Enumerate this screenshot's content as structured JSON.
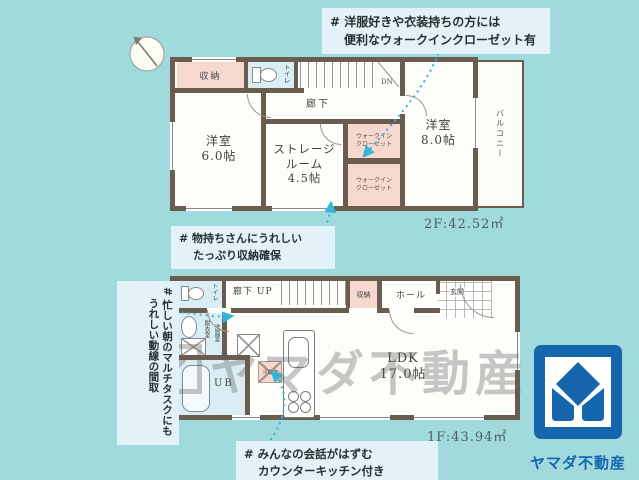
{
  "notes": {
    "wic": [
      "# 洋服好きや衣装持ちの方には",
      "便利なウォークインクローゼット有"
    ],
    "storage": [
      "# 物持ちさんにうれしい",
      "たっぷり収納確保"
    ],
    "morning": [
      "# 忙しい朝のマルチタスクにも",
      "うれしい動線の間取"
    ],
    "kitchen": [
      "# みんなの会話がはずむ",
      "カウンターキッチン付き"
    ]
  },
  "floor2": {
    "area": "2F:42.52㎡",
    "closet": "収納",
    "toilet": "トイレ",
    "hallway": "廊下",
    "stairs_dn": "DN",
    "bedroom6": "洋室",
    "bedroom6_size": "6.0帖",
    "storage_room_1": "ストレージ",
    "storage_room_2": "ルーム",
    "storage_room_size": "4.5帖",
    "wic_line1": "ウォークイン",
    "wic_line2": "クローゼット",
    "bedroom8": "洋室",
    "bedroom8_size": "8.0帖",
    "balcony": "バルコニー"
  },
  "floor1": {
    "area": "1F:43.94㎡",
    "toilet": "トイレ",
    "hallway_up": "廊下 UP",
    "closet": "収納",
    "hall": "ホール",
    "entrance": "玄関",
    "dressing": "脱衣室",
    "washroom": "洗面室",
    "bath": "UB",
    "ldk": "LDK",
    "ldk_size": "17.0帖",
    "fridge": "冷蔵庫"
  },
  "watermark_text": "ヤマダ不動産",
  "logo": {
    "text": "ヤマダ不動産"
  },
  "colors": {
    "background": "#a0dadd",
    "wall": "#6a5d50",
    "closet_pink": "#f6d8cf",
    "wet_blue": "#d9edf4",
    "note_bg": "#e3f1f8",
    "dotted_cyan": "#35b6d9",
    "logo_blue": "#1566ac",
    "watermark_gray": "#5c5c5c"
  }
}
